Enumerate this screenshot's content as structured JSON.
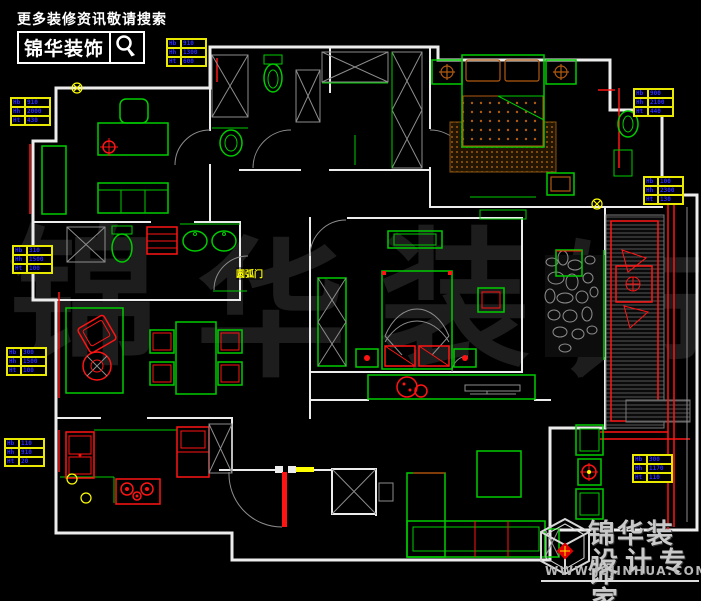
{
  "canvas": {
    "width": 701,
    "height": 601
  },
  "colors": {
    "bg": "#000000",
    "wall": "#ececec",
    "furniture": "#00cc00",
    "accent": "#ff1414",
    "wood": "#b05a10",
    "wood_dark": "#5a3a08",
    "dim_border": "#e8e800",
    "dim_text": "#2a2aff",
    "grey": "#8d8d8d",
    "watermark": "#1d1d1d",
    "yellow": "#ffff00"
  },
  "header": {
    "slogan": "更多装修资讯敬请搜索",
    "brand": "锦华装饰",
    "search_icon": "magnifier"
  },
  "watermark": {
    "chars": [
      "锦",
      "华",
      "装",
      "饰"
    ]
  },
  "labels": {
    "arc_door": "圆弧门"
  },
  "dim_tables": [
    {
      "rows": [
        [
          "Hb",
          "910"
        ],
        [
          "Hh",
          "1300"
        ],
        [
          "Ht",
          "600"
        ]
      ]
    },
    {
      "rows": [
        [
          "Hb",
          "910"
        ],
        [
          "Hh",
          "2000"
        ],
        [
          "Ht",
          "430"
        ]
      ]
    },
    {
      "rows": [
        [
          "Hb",
          "310"
        ],
        [
          "Hh",
          "1500"
        ],
        [
          "Ht",
          "100"
        ]
      ]
    },
    {
      "rows": [
        [
          "Hb",
          "300"
        ],
        [
          "Hh",
          "1500"
        ],
        [
          "Ht",
          "100"
        ]
      ]
    },
    {
      "rows": [
        [
          "Hb",
          "110"
        ],
        [
          "Hh",
          "910"
        ],
        [
          "Ht",
          "20"
        ]
      ]
    },
    {
      "rows": [
        [
          "Hb",
          "900"
        ],
        [
          "Hh",
          "2100"
        ],
        [
          "Ht",
          "440"
        ]
      ]
    },
    {
      "rows": [
        [
          "Hb",
          "100"
        ],
        [
          "Hh",
          "2300"
        ],
        [
          "Ht",
          "130"
        ]
      ]
    },
    {
      "rows": [
        [
          "Hb",
          "300"
        ],
        [
          "Hh",
          "1170"
        ],
        [
          "Ht",
          "110"
        ]
      ]
    }
  ],
  "footer": {
    "brand": "锦华装饰",
    "tagline": "设计专家",
    "website": "WWW.JSJINHUA.COM",
    "cube_icon": "cube-logo"
  }
}
